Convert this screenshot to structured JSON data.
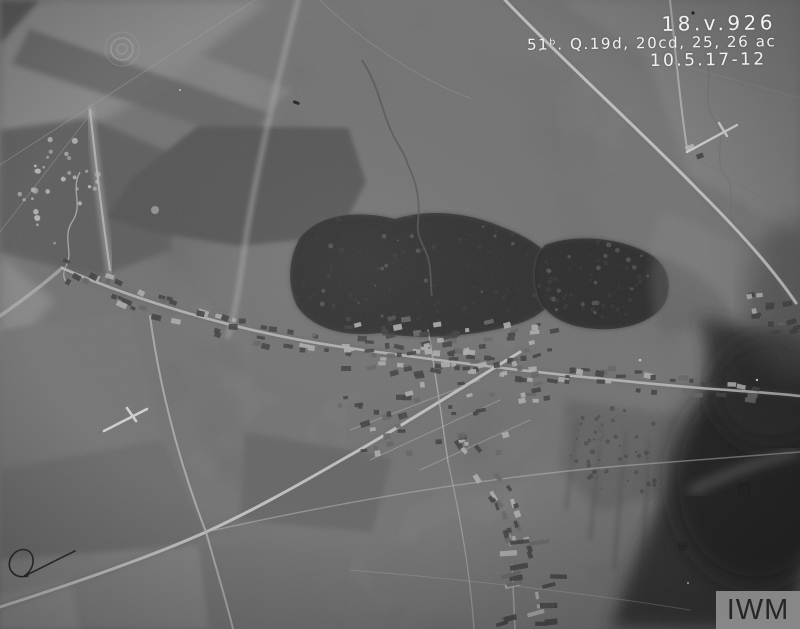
{
  "photo": {
    "description": "First World War vertical aerial reconnaissance photograph of a village, fields, roads and woodland",
    "annotations": {
      "line1": "18.v.926",
      "line2": "51ᵇ. Q.19d, 20cd, 25, 26 ac",
      "line3": "10.5.17-12"
    },
    "ink_color": "#f2f2f2",
    "marks": {
      "left_cross": "white annotation cross on field south-west of village",
      "right_cross": "white annotation cross beside road north-east of village",
      "pen_squiggle": "black ink squiggle in bottom-left corner"
    }
  },
  "watermark": {
    "text": "IWM",
    "background": "#8e8e8e",
    "color": "#262626"
  },
  "palette": {
    "base_grey": "#878787",
    "dark_field": "#585858",
    "woods": "#4e4e4e",
    "deep_shadow": "#161616",
    "road_light": "#e3e3e3"
  }
}
